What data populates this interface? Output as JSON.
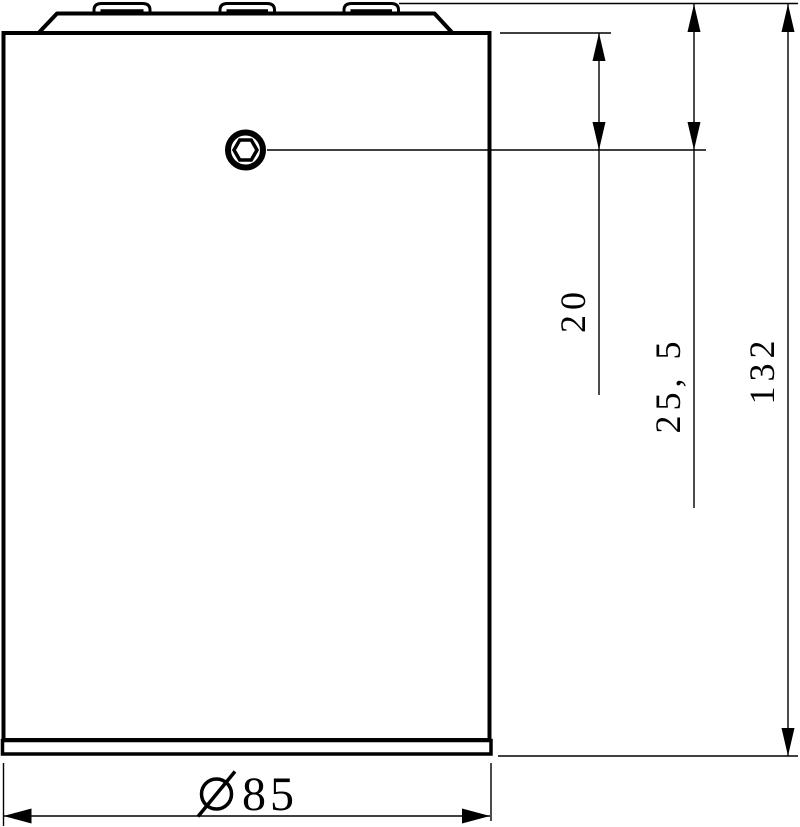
{
  "drawing": {
    "description": "Side-view technical drawing of cylindrical housing with chamfered top cap, three tabs and hex-socket screw",
    "background_color": "#ffffff",
    "line_color": "#000000",
    "labels": {
      "dim_screw_from_shoulder": "20",
      "dim_screw_from_top": "25, 5",
      "dim_overall_height": "132",
      "dim_diameter_value": "85",
      "diameter_symbol": "Ø"
    },
    "features": {
      "tab_count": 3,
      "screw_type": "hex-socket"
    }
  }
}
